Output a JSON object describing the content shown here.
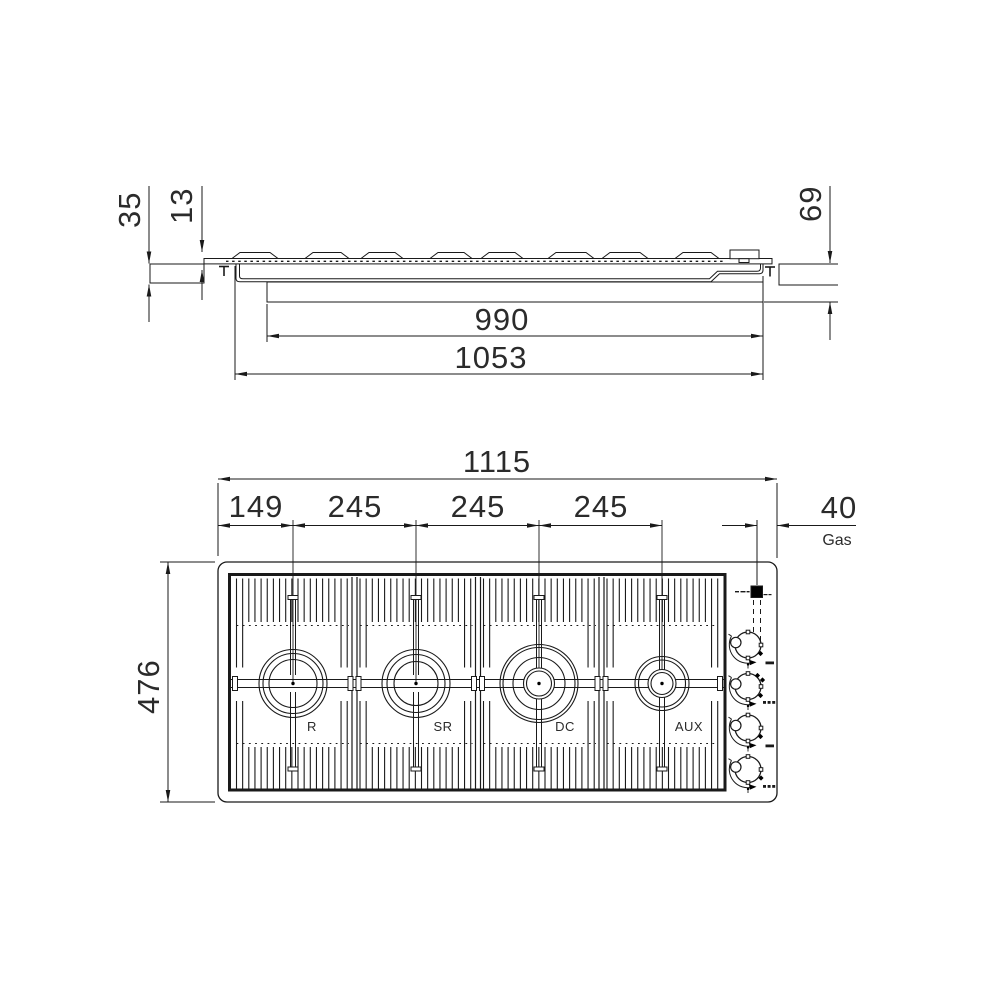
{
  "drawing": {
    "title_hint": "gas hob installation drawing",
    "line_color": "#1a1a1a",
    "background": "#ffffff"
  },
  "side_view": {
    "dim_labels": {
      "counter_thickness": "35",
      "grate_height": "13",
      "body_depth": "69",
      "cutout_width": "990",
      "body_width": "1053"
    }
  },
  "top_view": {
    "dim_labels": {
      "overall_width": "1115",
      "first_burner_offset": "149",
      "burner_spacing_1": "245",
      "burner_spacing_2": "245",
      "burner_spacing_3": "245",
      "gas_offset": "40",
      "gas_text": "Gas",
      "overall_depth": "476"
    },
    "burners": [
      {
        "label": "R"
      },
      {
        "label": "SR"
      },
      {
        "label": "DC"
      },
      {
        "label": "AUX"
      }
    ],
    "icons": {
      "gas_connection_marker": "black-square",
      "knob_marker": "control-knob-dial",
      "flame_marks": "min-max-flame-symbols"
    }
  }
}
